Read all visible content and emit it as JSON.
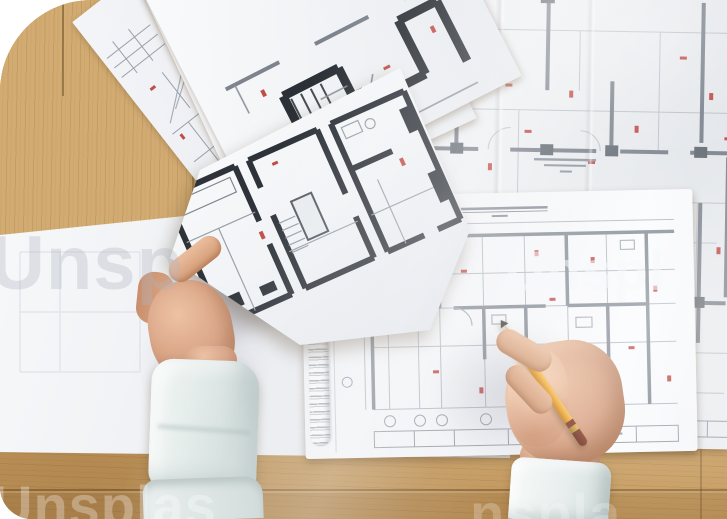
{
  "scene": {
    "description": "Top-down photo of an architect's desk: light oak wooden table, fanned floor-plan sheets, a large annotated blueprint, a spiral-bound sketchpad with a floor plan, a left hand holding a bold floor-plan sheet and a right hand drawing with a yellow pencil",
    "objects": [
      "wooden-table",
      "large-blueprint",
      "fanned-floor-plan-sheets",
      "spiral-sketchpad",
      "held-floor-plan-sheet",
      "left-hand",
      "right-hand",
      "yellow-pencil",
      "mint-shirt-sleeves"
    ]
  },
  "watermark": {
    "tiles": [
      {
        "text": "Unsp"
      },
      {
        "text": "Unspl"
      },
      {
        "text": "Unsplas"
      },
      {
        "text": "nspla"
      }
    ]
  },
  "palette": {
    "wood": "#cda467",
    "wood_seam": "#6b4a22",
    "paper_white": "#f3f4f7",
    "paper_shadow": "#dde1e7",
    "blueprint_wall": "#7d848e",
    "bold_wall": "#2e333a",
    "red_annotation": "#c14b46",
    "pencil_yellow": "#eaa93e",
    "pencil_end_maroon": "#7c3a2b",
    "skin": "#d7a183",
    "sleeve_mint": "#dfe8e7",
    "spiral_wire": "#b9bec6"
  }
}
